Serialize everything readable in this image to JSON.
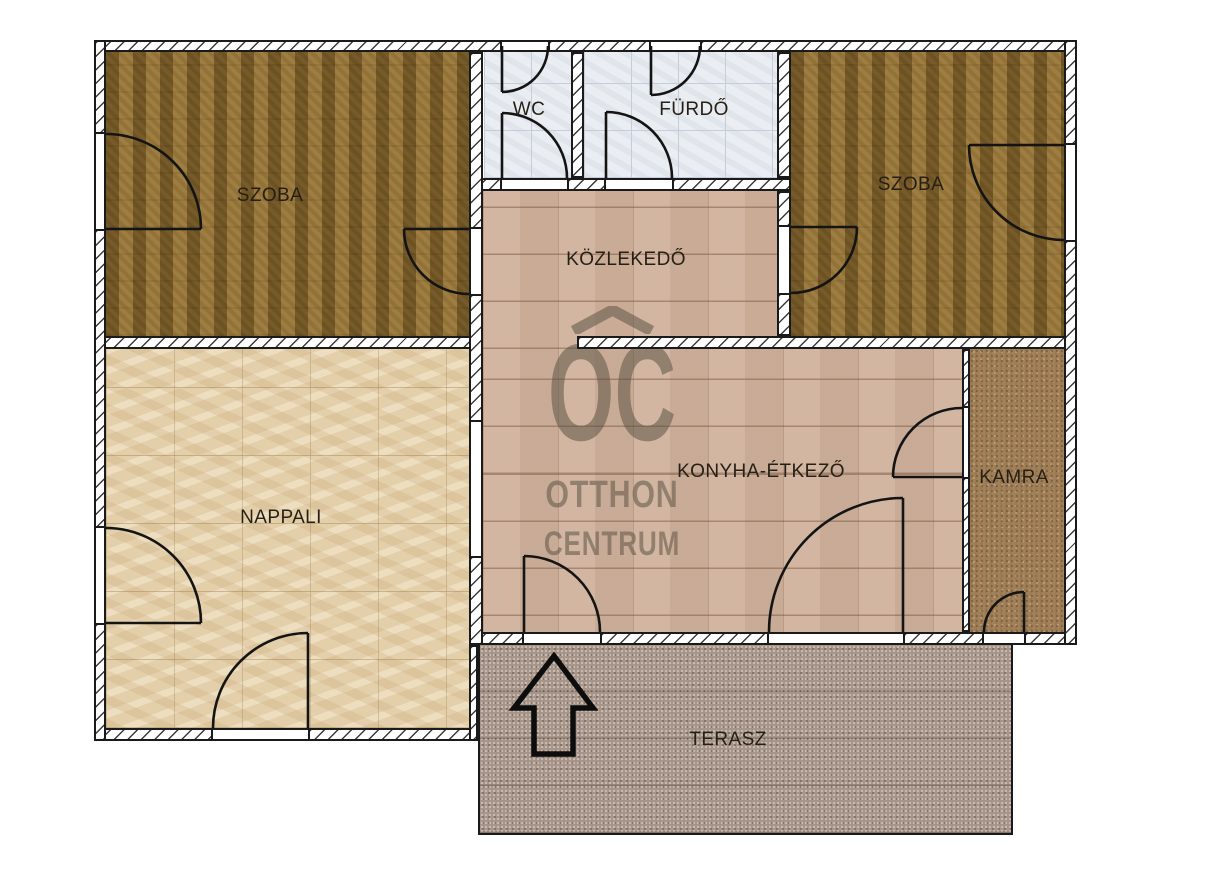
{
  "floorplan": {
    "rooms": {
      "szoba_left": {
        "label": "SZOBA"
      },
      "wc": {
        "label": "WC"
      },
      "furdo": {
        "label": "FÜRDŐ"
      },
      "szoba_right": {
        "label": "SZOBA"
      },
      "kozlekedo": {
        "label": "KÖZLEKEDŐ"
      },
      "nappali": {
        "label": "NAPPALI"
      },
      "konyha_etkezo": {
        "label": "KONYHA-ÉTKEZŐ"
      },
      "kamra": {
        "label": "KAMRA"
      },
      "terasz": {
        "label": "TERASZ"
      }
    },
    "watermark": {
      "abbr": "OC",
      "line1": "OTTHON",
      "line2": "CENTRUM"
    }
  },
  "colors": {
    "wall-line": "#1a1a1a",
    "carpet": "#8d6b2e",
    "bath-tile": "#eaedf2",
    "bath-line": "#c6cdda",
    "hall-tile": "#cfb19c",
    "nappali-floor": "#e4cfab",
    "kamra-floor": "#a28159",
    "terasz-floor": "#a69588",
    "watermark": "rgba(88,78,66,0.52)"
  }
}
